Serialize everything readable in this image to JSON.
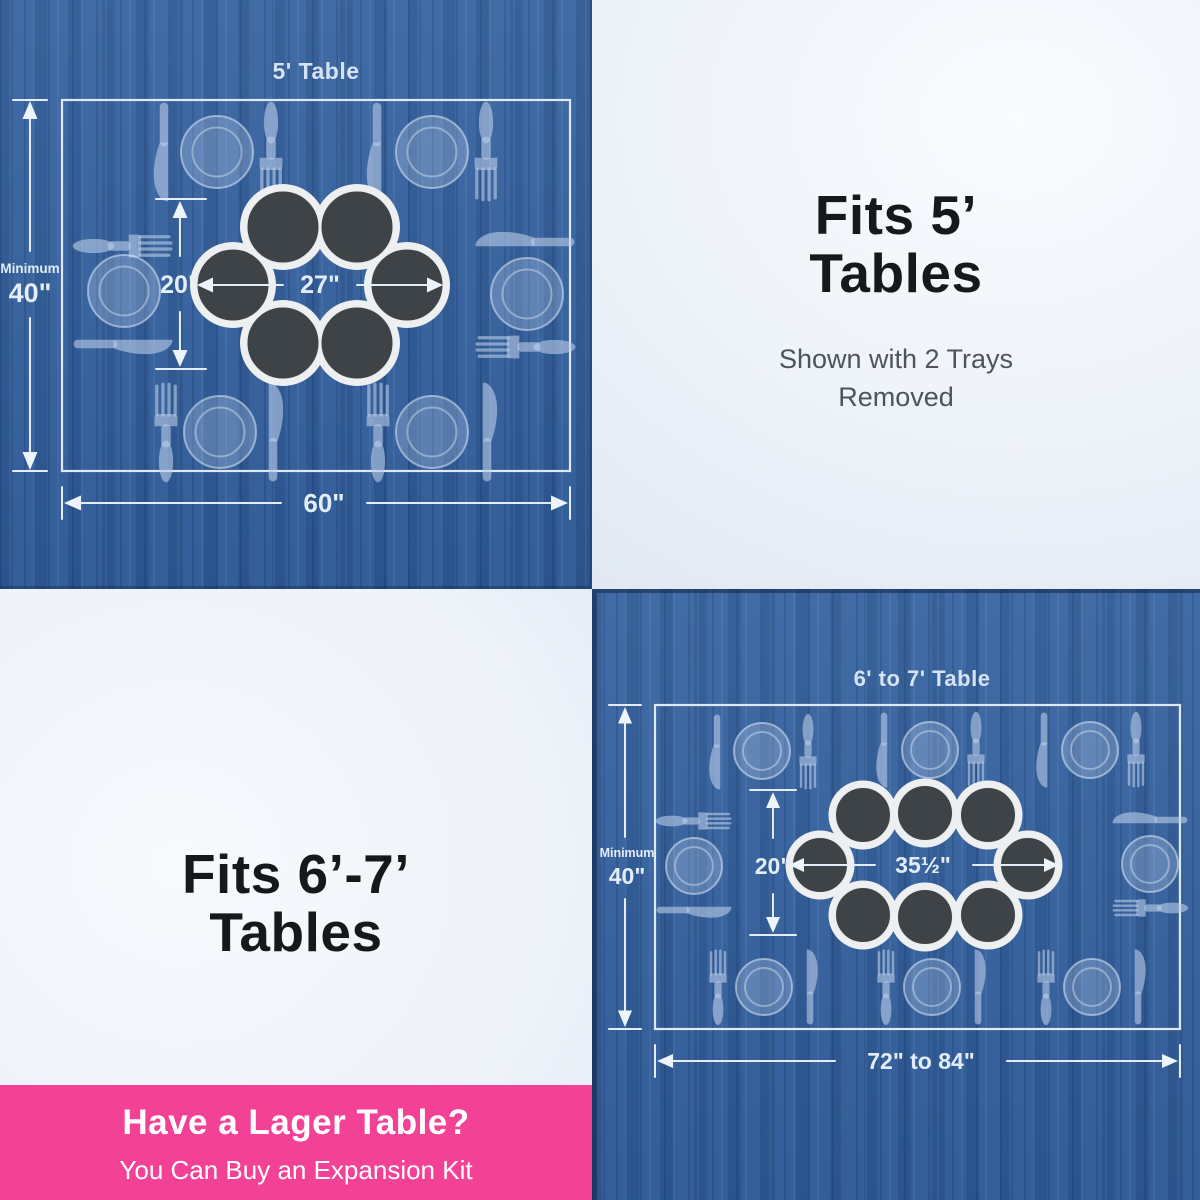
{
  "diagram_5ft": {
    "title": "5' Table",
    "minimum_label": "Minimum",
    "minimum_value": "40\"",
    "table_width": "60\"",
    "cluster_height": "20\"",
    "cluster_width": "27\"",
    "trays_shown": 6,
    "place_settings": 6
  },
  "caption_5ft": {
    "heading_line1": "Fits 5’",
    "heading_line2": "Tables",
    "subtext_line1": "Shown with 2 Trays",
    "subtext_line2": "Removed"
  },
  "caption_67ft": {
    "heading_line1": "Fits 6’-7’",
    "heading_line2": "Tables"
  },
  "diagram_67ft": {
    "title": "6' to 7' Table",
    "minimum_label": "Minimum",
    "minimum_value": "40\"",
    "table_width": "72\" to 84\"",
    "cluster_height": "20\"",
    "cluster_width": "35½\"",
    "trays_shown": 8,
    "place_settings": 8
  },
  "banner": {
    "title": "Have a Lager Table?",
    "subtitle": "You Can Buy an Expansion Kit"
  },
  "colors": {
    "table_blue": "#32609e",
    "banner_pink": "#f34296",
    "diagram_line": "#e3ecf8",
    "tray_dark": "#3e4347",
    "tray_base": "#edeff0",
    "heading_text": "#17181a",
    "subtext": "#4e545c"
  }
}
